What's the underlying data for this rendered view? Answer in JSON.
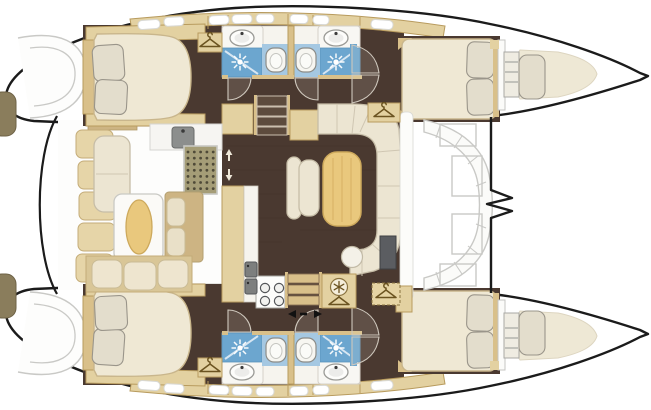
{
  "figure": {
    "type": "yacht-floor-plan",
    "vessel": "catamaran",
    "view": "overhead deck plan, bows pointing right",
    "decks": [
      "port hull",
      "starboard hull",
      "bridgedeck salon",
      "aft cockpit",
      "foredeck"
    ]
  },
  "rooms": [
    "aft cockpit with table and wraparound seating",
    "salon with U-shaped sofa, table, bench and stool",
    "galley with twin sinks and 4-burner stove",
    "port aft cabin with island double berth",
    "starboard aft cabin with island double berth",
    "port forward cabin with double berth",
    "starboard forward cabin with double berth",
    "four heads with shower, toilet and washbasin",
    "two forepeak berths"
  ],
  "palette": {
    "outline": "#1b1b1b",
    "deck-line": "#c9c9c6",
    "floor": "#4a3930",
    "tan": "#e3d1a1",
    "tan-dark": "#d9c08a",
    "trim": "#b89b5e",
    "khaki": "#cdb483",
    "cream": "#ece5d2",
    "cream-line": "#c6bda7",
    "mattress": "#efe8d4",
    "pillow": "#e3ddcc",
    "pillow-line": "#9a958a",
    "wood": "#e9c87d",
    "wood-line": "#cda95c",
    "shower": "#6ca6cf",
    "shower-light": "#a5c8e2",
    "fixture-white": "#f7f6f1",
    "steel": "#8c8e8d",
    "grate": "#a59d77",
    "grate-dot": "#4f4a38",
    "tv": "#5b5d61",
    "icon": "#6b5320",
    "arrow": "#111111"
  },
  "placements": {
    "hangers": [
      [
        210,
        44
      ],
      [
        384,
        114
      ],
      [
        339,
        302
      ],
      [
        386,
        295
      ],
      [
        210,
        369
      ]
    ],
    "snowflakes": [
      [
        339,
        287
      ]
    ],
    "sunbursts": [
      [
        240,
        62
      ],
      [
        336,
        62
      ],
      [
        240,
        348
      ],
      [
        336,
        348
      ]
    ],
    "toilets": [
      [
        276,
        60
      ],
      [
        306,
        60
      ],
      [
        276,
        350
      ],
      [
        306,
        350
      ]
    ],
    "sinks": [
      [
        242,
        38
      ],
      [
        336,
        38
      ],
      [
        242,
        372
      ],
      [
        336,
        372
      ]
    ],
    "burners": [
      [
        265,
        288
      ],
      [
        279,
        288
      ],
      [
        265,
        301
      ],
      [
        279,
        301
      ]
    ],
    "galley_sinks": [
      [
        245,
        262
      ],
      [
        245,
        279
      ]
    ],
    "grate": {
      "x": 188,
      "y": 152,
      "cols": 5,
      "rows": 7,
      "dx": 6.3,
      "dy": 6.1
    },
    "windows": [
      [
        138,
        20,
        22,
        -4
      ],
      [
        164,
        17,
        20,
        -3
      ],
      [
        209,
        15.5,
        20,
        -2
      ],
      [
        232,
        14.5,
        20,
        -1
      ],
      [
        256,
        14,
        18,
        0
      ],
      [
        290,
        14.5,
        18,
        1
      ],
      [
        313,
        15.5,
        16,
        2
      ],
      [
        371,
        20,
        22,
        4
      ]
    ],
    "window_h": 9,
    "updown_arrows": [
      [
        229,
        152
      ],
      [
        229,
        178
      ]
    ],
    "slide_door": {
      "x": 303,
      "y": 314
    }
  }
}
